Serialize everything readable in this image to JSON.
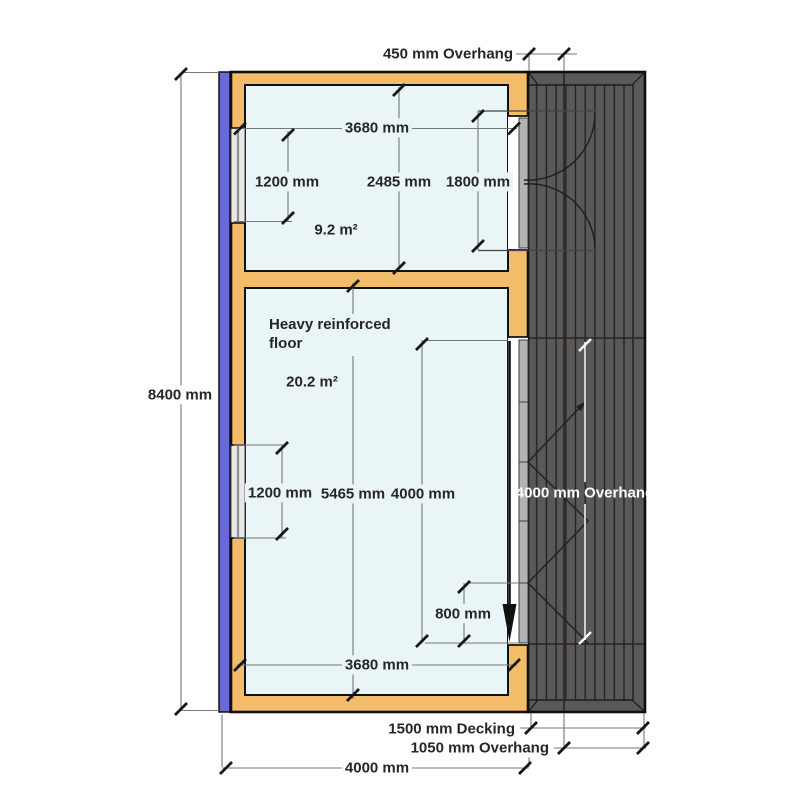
{
  "plan": {
    "overall_height": "8400 mm",
    "overall_width": "4000 mm",
    "roof_overhang_top": "450 mm Overhang",
    "room_top": {
      "width": "3680 mm",
      "window_width": "1200 mm",
      "depth": "2485 mm",
      "door_width": "1800 mm",
      "area": "9.2 m²"
    },
    "room_bottom": {
      "note_line1": "Heavy reinforced",
      "note_line2": "floor",
      "area": "20.2 m²",
      "window_width": "1200 mm",
      "depth": "5465 mm",
      "door_width": "4000 mm",
      "door_offset": "800 mm",
      "width": "3680 mm"
    },
    "deck": {
      "overhang_right": "4000 mm Overhang",
      "decking_depth": "1500 mm Decking",
      "overhang_bottom": "1050 mm Overhang"
    },
    "colors": {
      "timber_wall": "#f2bc69",
      "insulated_wall": "#6a6ad6",
      "floor": "#e9f5f7",
      "decking": "#595959",
      "outline": "#111111",
      "dimension_text": "#262626",
      "deck_dimension_text": "#ffffff"
    }
  }
}
